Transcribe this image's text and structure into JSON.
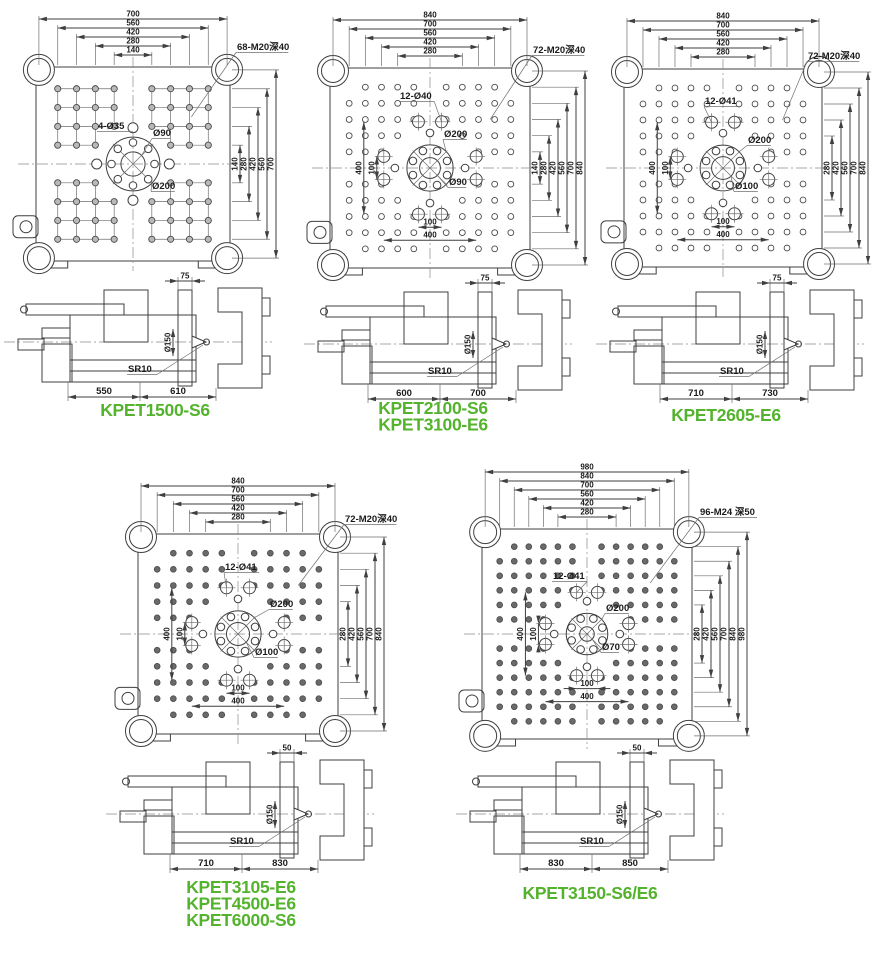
{
  "page": {
    "background": "#ffffff",
    "accent_green": "#54b32c",
    "line_color": "#3f3f3f"
  },
  "diagrams": [
    {
      "models": [
        "KPET1500-S6"
      ],
      "plate": {
        "top_dims": [
          "700",
          "560",
          "420",
          "280",
          "140"
        ],
        "right_dims": [
          "140",
          "280",
          "420",
          "560",
          "700"
        ],
        "left_dims": [],
        "bottom_dims": [],
        "thread_label": "68-M20深40",
        "pattern_label": "4-Ø35",
        "inner_circle_label": "Ø90",
        "outer_circle_label": "Ø200"
      },
      "side": {
        "platen_offset_dim": "75",
        "ring_label": "Ø150",
        "sprue_radius_label": "SR10",
        "base_dims": [
          "550",
          "610"
        ]
      }
    },
    {
      "models": [
        "KPET2100-S6",
        "KPET3100-E6"
      ],
      "plate": {
        "top_dims": [
          "840",
          "700",
          "560",
          "420",
          "280"
        ],
        "right_dims": [
          "140",
          "280",
          "420",
          "560",
          "700",
          "840"
        ],
        "left_dims": [
          "400",
          "100"
        ],
        "bottom_dims": [
          "100",
          "400"
        ],
        "thread_label": "72-M20深40",
        "pattern_label": "12-Ø40",
        "inner_circle_label": "Ø90",
        "outer_circle_label": "Ø200"
      },
      "side": {
        "platen_offset_dim": "75",
        "ring_label": "Ø150",
        "sprue_radius_label": "SR10",
        "base_dims": [
          "600",
          "700"
        ]
      }
    },
    {
      "models": [
        "KPET2605-E6"
      ],
      "plate": {
        "top_dims": [
          "840",
          "700",
          "560",
          "420",
          "280"
        ],
        "right_dims": [
          "280",
          "420",
          "560",
          "700",
          "840"
        ],
        "left_dims": [
          "400",
          "100"
        ],
        "bottom_dims": [
          "100",
          "400"
        ],
        "thread_label": "72-M20深40",
        "pattern_label": "12-Ø41",
        "inner_circle_label": "Ø100",
        "outer_circle_label": "Ø200"
      },
      "side": {
        "platen_offset_dim": "75",
        "ring_label": "Ø150",
        "sprue_radius_label": "SR10",
        "base_dims": [
          "710",
          "730"
        ]
      }
    },
    {
      "models": [
        "KPET3105-E6",
        "KPET4500-E6",
        "KPET6000-S6"
      ],
      "plate": {
        "top_dims": [
          "840",
          "700",
          "560",
          "420",
          "280"
        ],
        "right_dims": [
          "280",
          "420",
          "560",
          "700",
          "840"
        ],
        "left_dims": [
          "400",
          "100"
        ],
        "bottom_dims": [
          "100",
          "400"
        ],
        "thread_label": "72-M20深40",
        "pattern_label": "12-Ø41",
        "inner_circle_label": "Ø100",
        "outer_circle_label": "Ø200"
      },
      "side": {
        "platen_offset_dim": "50",
        "ring_label": "Ø150",
        "sprue_radius_label": "SR10",
        "base_dims": [
          "710",
          "830"
        ]
      }
    },
    {
      "models": [
        "KPET3150-S6/E6"
      ],
      "plate": {
        "top_dims": [
          "980",
          "840",
          "700",
          "560",
          "420",
          "280"
        ],
        "right_dims": [
          "280",
          "420",
          "560",
          "700",
          "840",
          "980"
        ],
        "left_dims": [
          "400",
          "100"
        ],
        "bottom_dims": [
          "100",
          "400"
        ],
        "thread_label": "96-M24 深50",
        "pattern_label": "12-Ø41",
        "inner_circle_label": "Ø70",
        "outer_circle_label": "Ø200"
      },
      "side": {
        "platen_offset_dim": "50",
        "ring_label": "Ø150",
        "sprue_radius_label": "SR10",
        "base_dims": [
          "830",
          "850"
        ]
      }
    }
  ]
}
